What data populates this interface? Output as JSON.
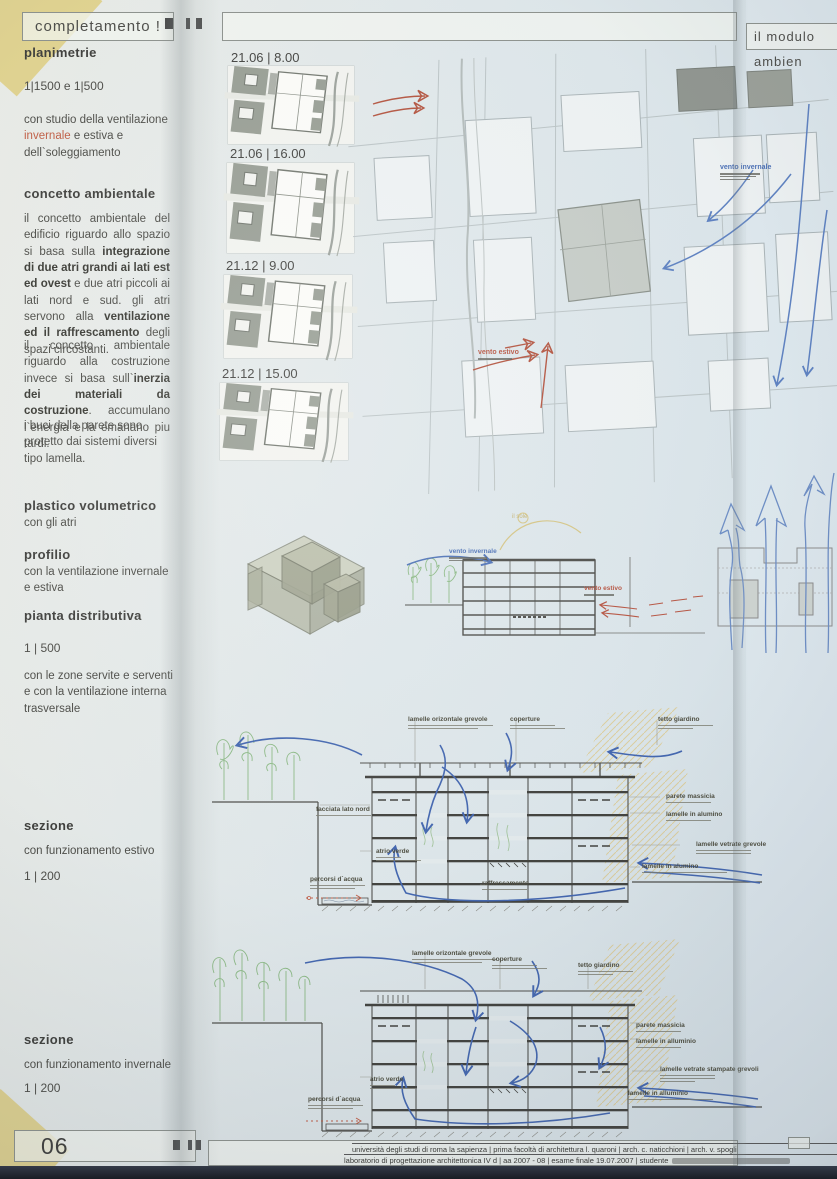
{
  "poster": {
    "header": {
      "left_title": "completamento !",
      "right_title": "il modulo ambien"
    },
    "sidebar": {
      "s1_heading": "planimetrie",
      "s1_scale": "1|1500  e  1|500",
      "s1_body_pre": "con studio della ventilazione ",
      "s1_accent": "invernale",
      "s1_body_post": " e estiva e dell`soleggiamento",
      "s2_heading": "concetto ambientale",
      "p1_1": "il concetto ambientale del edificio riguardo allo spazio si basa sulla ",
      "p1_b1": "integrazione di due atri grandi ai lati est ed ovest",
      "p1_2": " e due atri piccoli ai lati nord e sud. gli atri servono alla ",
      "p1_b2": "ventilazione ed il raffrescamento",
      "p1_3": " degli spazi circostanti.",
      "p2_1": "il concetto ambientale riguardo alla costruzione invece si basa sull`",
      "p2_b1": "inerzia dei materiali da costruzione",
      "p2_2": ". accumulano l`energia e la emanano piu tardi.",
      "p2_3": "i buci della parete sono protetto dai sistemi diversi tipo lamella.",
      "s3_heading": "plastico volumetrico",
      "s3_sub": "con gli atri",
      "s4_heading": "profilio",
      "s4_sub": "con la ventilazione invernale e estiva",
      "s5_heading": "pianta distributiva",
      "s5_scale": "1 | 500",
      "s5_sub": "con le zone servite e serventi e con la ventilazione interna trasversale",
      "s6_heading": "sezione",
      "s6_sub": "con funzionamento estivo",
      "s6_scale": "1 | 200",
      "s7_heading": "sezione",
      "s7_sub": "con funzionamento invernale",
      "s7_scale": "1 | 200"
    },
    "thumbnails": [
      {
        "label": "21.06 | 8.00"
      },
      {
        "label": "21.06 | 16.00"
      },
      {
        "label": "21.12 | 9.00"
      },
      {
        "label": "21.12 | 15.00"
      }
    ],
    "site_plan": {
      "wind_summer": "vento estivo",
      "wind_winter": "vento invernale"
    },
    "profile": {
      "sun": "il sole",
      "wind_winter": "vento invernale",
      "wind_summer": "vento estivo"
    },
    "section_summer": {
      "top": [
        "lamelle orizontale grevole",
        "coperture",
        "tetto giardino"
      ],
      "left": [
        "facciata lato nord",
        "atrio verde",
        "percorsi d`acqua",
        "raffrescamento"
      ],
      "right": [
        "parete massicia",
        "lamelle in alumino",
        "lamelle vetrate grevole",
        "lamelle in alumino"
      ]
    },
    "section_winter": {
      "top": [
        "lamelle orizontale grevole",
        "coperture",
        "tetto giardino"
      ],
      "left": [
        "atrio verde",
        "percorsi d`acqua"
      ],
      "right": [
        "parete massicia",
        "lamelle in alluminio",
        "lamelle vetrate stampate grevoli",
        "lamelle in alluminio"
      ]
    },
    "footer": {
      "page_number": "06",
      "line1": "università degli studi di roma la sapienza | prima facoltà di architettura l. quaroni | arch. c. naticchioni | arch. v. spogli",
      "line2": "laboratorio di progettazione architettonica IV d | aa 2007 - 08 | esame finale 19.07.2007 | studente"
    },
    "colors": {
      "accent_red": "#b5513e",
      "accent_blue": "#4a6fb5",
      "accent_yellow": "#d9c88a"
    }
  }
}
